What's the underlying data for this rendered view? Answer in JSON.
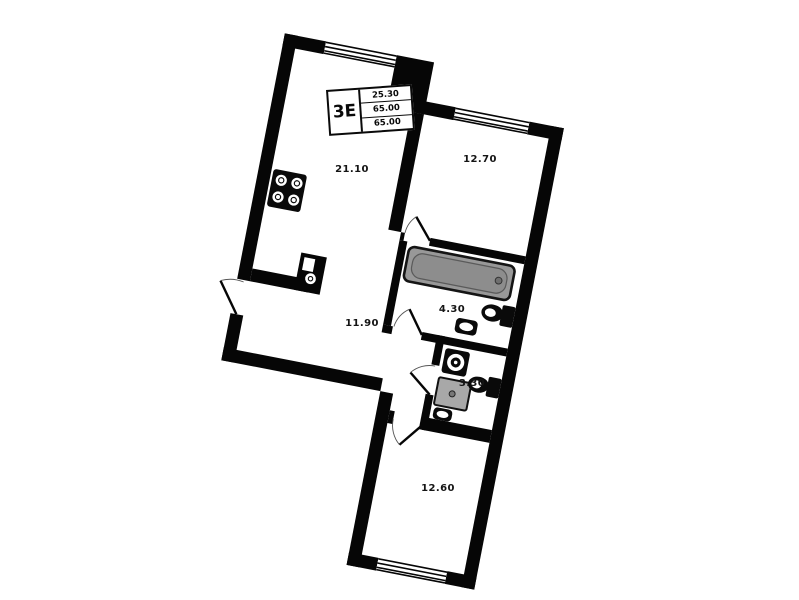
{
  "plan": {
    "title_block": {
      "type_label": "3Е",
      "values": [
        "25.30",
        "65.00",
        "65.00"
      ]
    },
    "rooms": [
      {
        "id": "living-kitchen",
        "area": "21.10"
      },
      {
        "id": "bedroom-top",
        "area": "12.70"
      },
      {
        "id": "bathroom",
        "area": "4.30"
      },
      {
        "id": "hallway",
        "area": "11.90"
      },
      {
        "id": "wc",
        "area": "3.30"
      },
      {
        "id": "bedroom-bottom",
        "area": "12.60"
      }
    ],
    "colors": {
      "wall": "#060606",
      "background": "#ffffff",
      "bathtub": "#989898",
      "shower_tray": "#a8a8a8"
    }
  }
}
